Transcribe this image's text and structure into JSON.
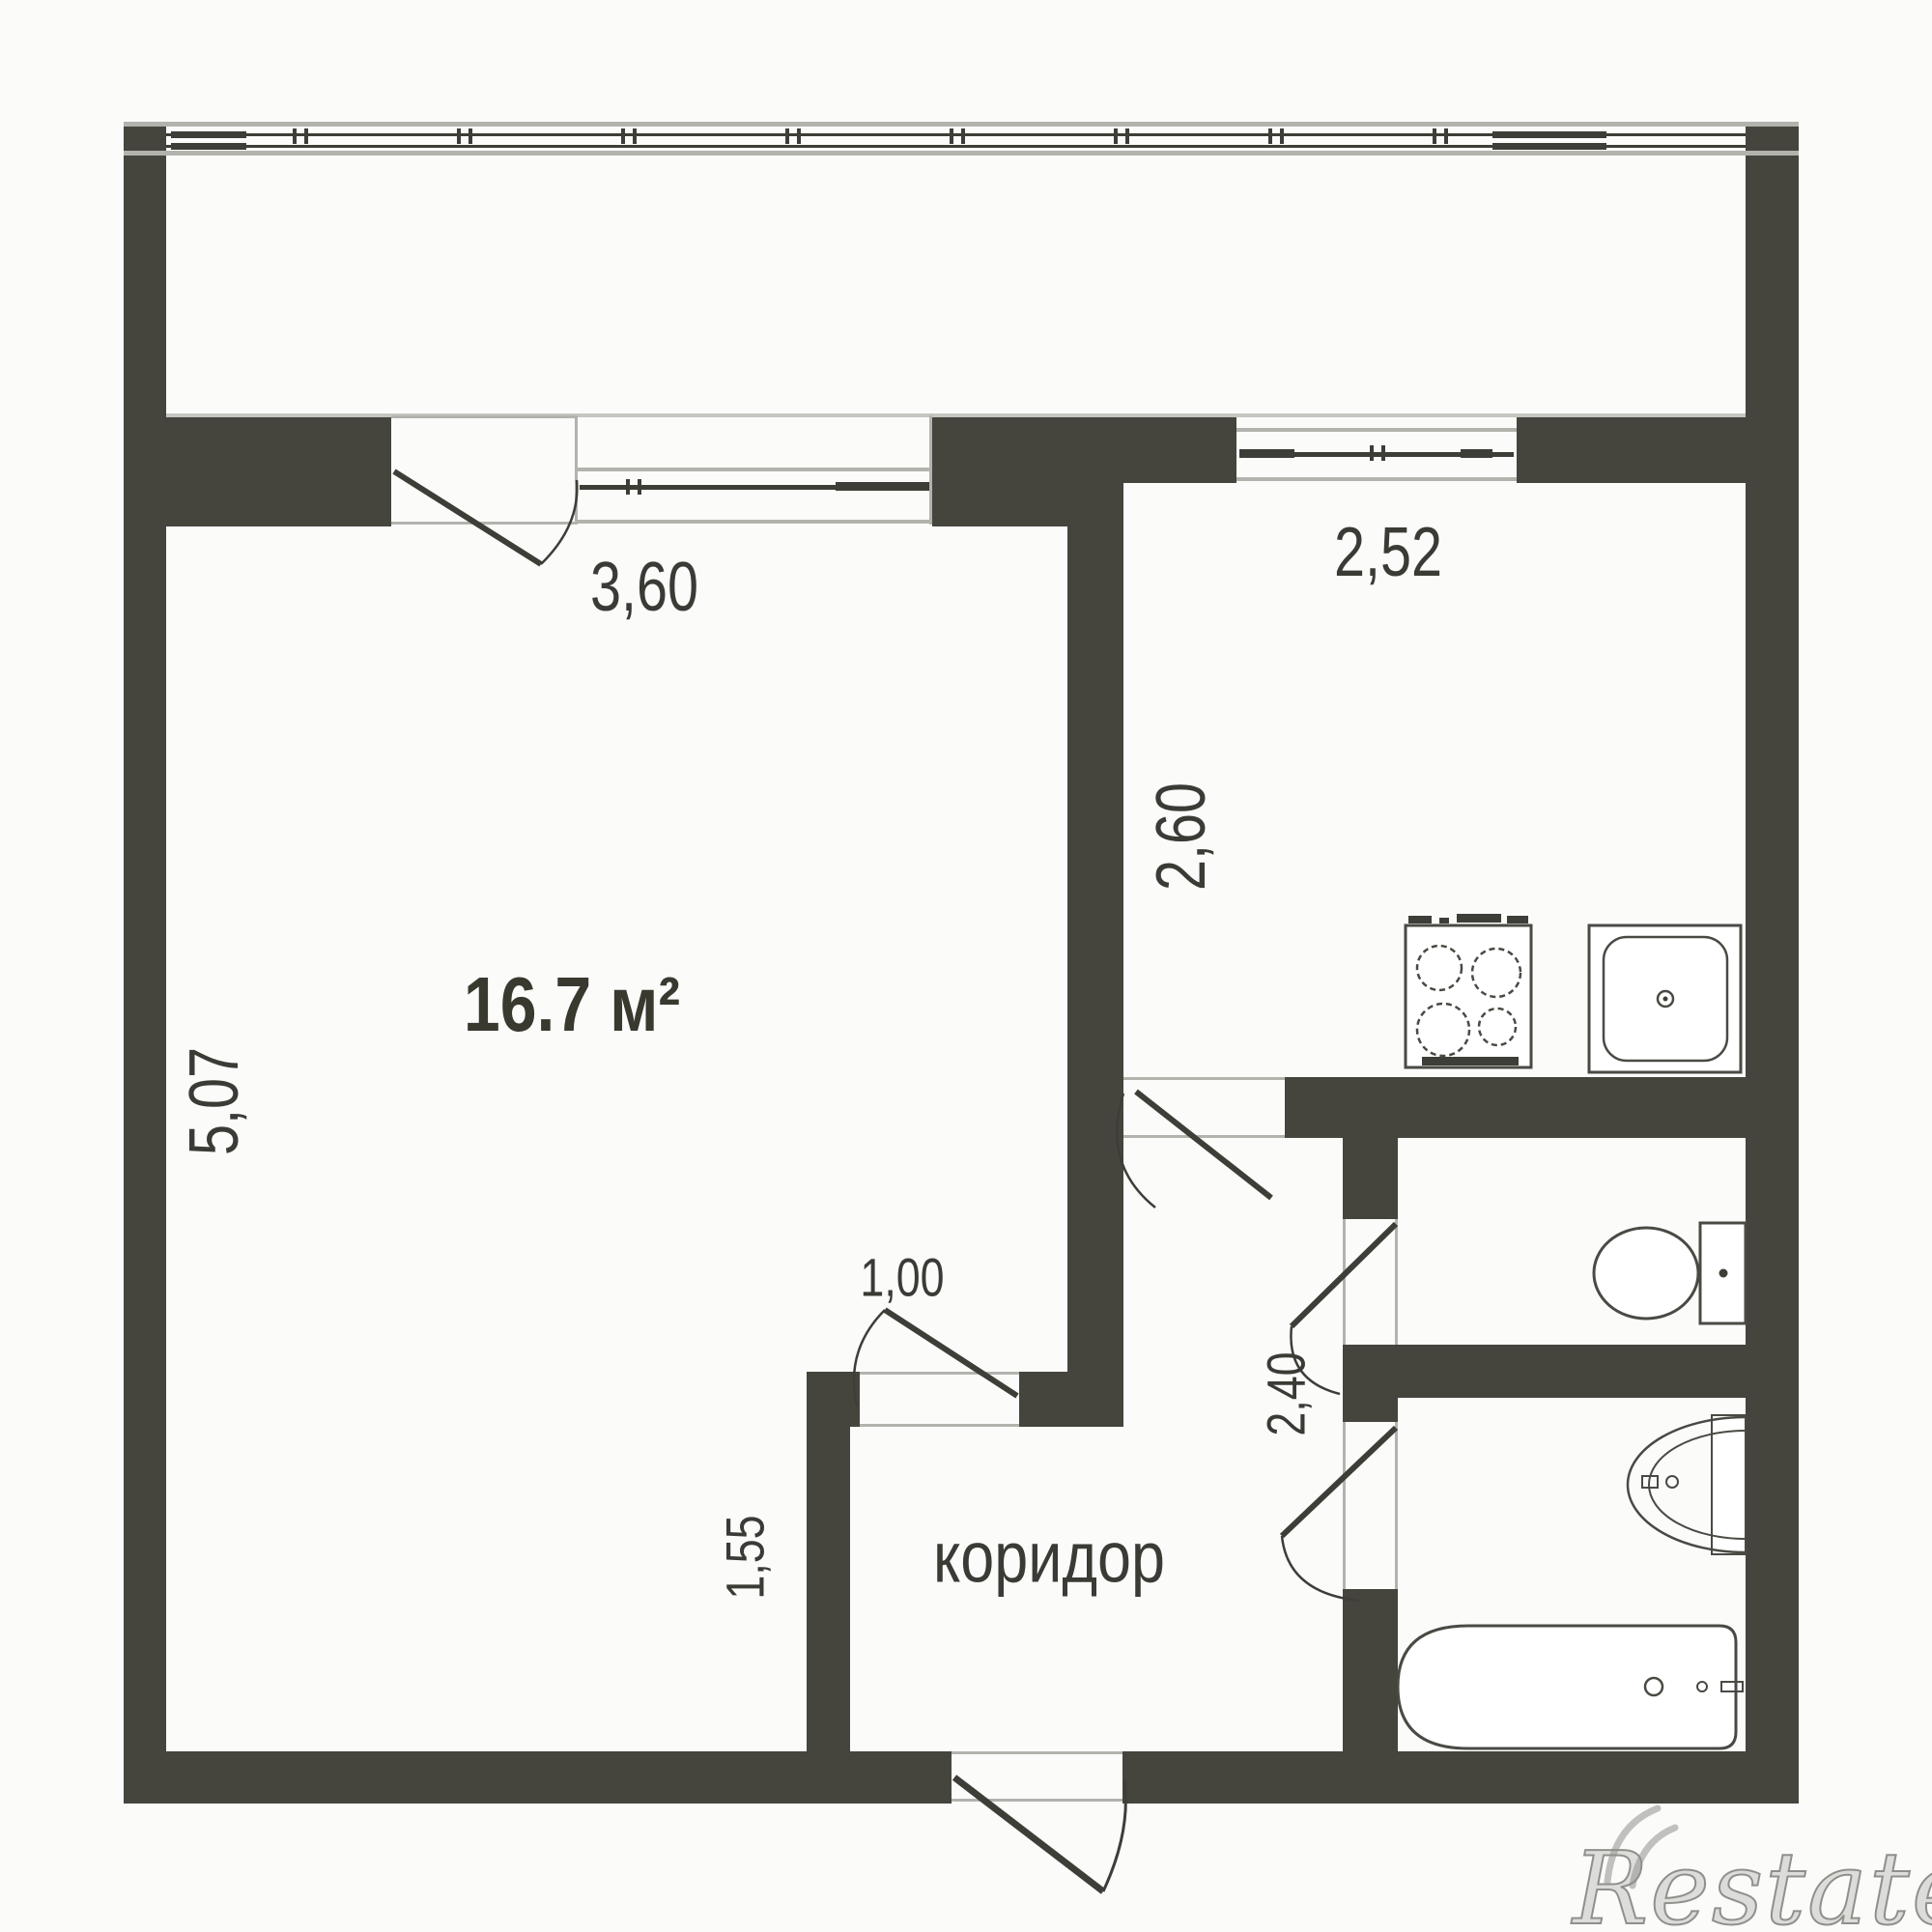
{
  "plan": {
    "room": {
      "area": "16.7 м²",
      "width_label": "3,60",
      "height_label": "5,07",
      "door_label": "1,00"
    },
    "kitchen": {
      "width_label": "2,52",
      "height_label": "2,60"
    },
    "corridor": {
      "name": "коридор",
      "height_label": "1,55"
    },
    "bathroom": {
      "height_label": "2,40"
    },
    "watermark": "Restate",
    "colors": {
      "wall": "#45453e",
      "line": "#3e3e38",
      "fixture_line": "#4a4a44",
      "light_line": "#b3b3ae",
      "background": "#fbfbfa",
      "watermark": "#90908b"
    }
  }
}
